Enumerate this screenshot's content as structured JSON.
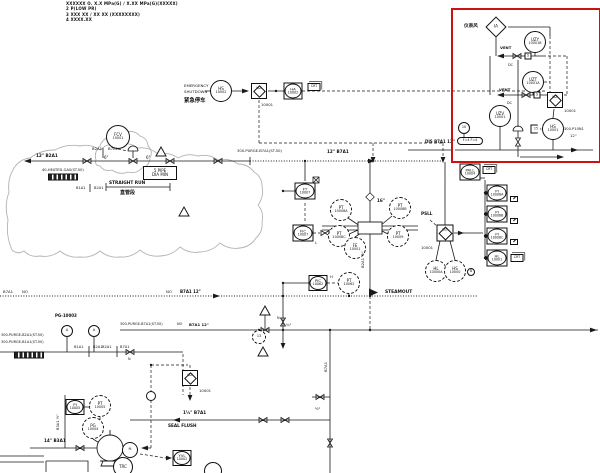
{
  "colors": {
    "highlight_box": "#cc1111",
    "diagram_line": "#1a1a1a",
    "cloud": "#b3b3b3"
  },
  "highlight_box": {
    "x": 451,
    "y": 8,
    "w": 146,
    "h": 151
  },
  "notes": [
    "XXXXXX O. X.X MPa(G) / X.XX MPa(G)(XXXXX)",
    "2    P(LOW PR)",
    "3    XXX XX / XX XX (XXXXXXXX)",
    "4    XXXX.XX"
  ],
  "instruments": [
    {
      "name": "instrument-air-diamond",
      "t": "diamond",
      "x": 496,
      "y": 27,
      "s": 15,
      "l1": "IA"
    },
    {
      "name": "uzy-10001b",
      "t": "circle",
      "x": 535,
      "y": 42,
      "r": 11,
      "l1": "UZY",
      "l2": "10001B"
    },
    {
      "name": "uzt-10001a",
      "t": "circle",
      "x": 533,
      "y": 82,
      "r": 11,
      "l1": "UZT",
      "l2": "10001A"
    },
    {
      "name": "uz-logic-redbox",
      "t": "logic",
      "x": 555,
      "y": 100,
      "s": 16,
      "l1": "UZ"
    },
    {
      "name": "uzv-10001",
      "t": "circle",
      "x": 500,
      "y": 116,
      "r": 11,
      "l1": "UZV",
      "l2": "10001"
    },
    {
      "name": "hs-10001",
      "t": "circle",
      "x": 553,
      "y": 129,
      "r": 11,
      "l1": "HS",
      "l2": "10001"
    },
    {
      "name": "flag-15",
      "t": "pent",
      "x": 536,
      "y": 129,
      "w": 11,
      "h": 9,
      "l1": "15"
    },
    {
      "name": "bubble-10",
      "t": "circle",
      "x": 464,
      "y": 128,
      "r": 6,
      "l1": "10"
    },
    {
      "name": "interlock-note",
      "t": "stadium",
      "x": 470,
      "y": 141,
      "w": 26,
      "h": 8,
      "l1": "F=4 F=4"
    },
    {
      "name": "solenoid-1",
      "t": "sbox",
      "x": 528,
      "y": 56,
      "w": 7,
      "h": 7,
      "l1": "S"
    },
    {
      "name": "solenoid-2",
      "t": "sbox",
      "x": 537,
      "y": 95,
      "w": 7,
      "h": 7,
      "l1": "S"
    },
    {
      "name": "hs-10002",
      "t": "circle",
      "x": 221,
      "y": 91,
      "r": 11,
      "l1": "HS",
      "l2": "10002"
    },
    {
      "name": "uz-logic-esd",
      "t": "logic",
      "x": 259,
      "y": 91,
      "s": 16,
      "l1": "UZ"
    },
    {
      "name": "ha-10002",
      "t": "sqcircle",
      "x": 293,
      "y": 91,
      "w": 19,
      "h": 17,
      "l1": "HA",
      "l2": "10002"
    },
    {
      "name": "crt-tag-esd",
      "t": "crt",
      "x": 314,
      "y": 87,
      "w": 13,
      "h": 8,
      "l1": "CRT"
    },
    {
      "name": "fcv-10001",
      "t": "circle",
      "x": 118,
      "y": 137,
      "r": 12,
      "l1": "FCV",
      "l2": "10001"
    },
    {
      "name": "ft-10007",
      "t": "sqcircle",
      "x": 305,
      "y": 191,
      "w": 21,
      "h": 17,
      "l1": "FT",
      "l2": "10007"
    },
    {
      "name": "fic-10007",
      "t": "sqcircle",
      "x": 303,
      "y": 233,
      "w": 21,
      "h": 17,
      "l1": "FIC",
      "l2": "10007"
    },
    {
      "name": "pt-10008a",
      "t": "circle",
      "x": 341,
      "y": 210,
      "r": 11,
      "dash": 1,
      "l1": "PT",
      "l2": "10008A"
    },
    {
      "name": "pt-10008b",
      "t": "circle",
      "x": 400,
      "y": 208,
      "r": 11,
      "dash": 1,
      "l1": "PT",
      "l2": "10008B"
    },
    {
      "name": "pt-10008c",
      "t": "circle",
      "x": 339,
      "y": 236,
      "r": 11,
      "dash": 1,
      "l1": "PT",
      "l2": "10008C"
    },
    {
      "name": "pt-10009",
      "t": "circle",
      "x": 398,
      "y": 236,
      "r": 11,
      "dash": 1,
      "l1": "PT",
      "l2": "10009"
    },
    {
      "name": "fe-10001",
      "t": "circle",
      "x": 355,
      "y": 248,
      "r": 11,
      "dash": 1,
      "l1": "FE",
      "l2": "10001"
    },
    {
      "name": "uz-logic-main",
      "t": "logic",
      "x": 445,
      "y": 233,
      "s": 17,
      "l1": "UZ"
    },
    {
      "name": "hl-10000a",
      "t": "circle",
      "x": 436,
      "y": 271,
      "r": 11,
      "dash": 1,
      "l1": "HL",
      "l2": "10000A"
    },
    {
      "name": "hs-10000",
      "t": "circle",
      "x": 455,
      "y": 271,
      "r": 11,
      "dash": 1,
      "l1": "HS",
      "l2": "10000"
    },
    {
      "name": "bubble-b",
      "t": "circle",
      "x": 471,
      "y": 272,
      "r": 4,
      "l1": "B"
    },
    {
      "name": "pall-10004",
      "t": "sqcircle",
      "x": 470,
      "y": 172,
      "w": 21,
      "h": 17,
      "l1": "PALL",
      "l2": "10004"
    },
    {
      "name": "crt-tag-pall",
      "t": "crt",
      "x": 489,
      "y": 170,
      "w": 13,
      "h": 8,
      "l1": "CRT"
    },
    {
      "name": "pi-10008a",
      "t": "sqcircle",
      "x": 497,
      "y": 193,
      "w": 21,
      "h": 17,
      "l1": "PI",
      "l2": "10008A"
    },
    {
      "name": "screen-tag-1",
      "t": "screen",
      "x": 514,
      "y": 199,
      "w": 8,
      "h": 6
    },
    {
      "name": "pi-10008b",
      "t": "sqcircle",
      "x": 497,
      "y": 214,
      "w": 21,
      "h": 17,
      "l1": "PI",
      "l2": "10008B"
    },
    {
      "name": "screen-tag-2",
      "t": "screen",
      "x": 514,
      "y": 221,
      "w": 8,
      "h": 6
    },
    {
      "name": "pi-10008c",
      "t": "sqcircle",
      "x": 497,
      "y": 236,
      "w": 21,
      "h": 17,
      "l1": "PI",
      "l2": "10008C"
    },
    {
      "name": "screen-tag-3",
      "t": "screen",
      "x": 514,
      "y": 242,
      "w": 8,
      "h": 6
    },
    {
      "name": "hl-10001-display",
      "t": "sqcircle",
      "x": 497,
      "y": 258,
      "w": 21,
      "h": 17,
      "l1": "HL",
      "l2": "10001"
    },
    {
      "name": "crt-tag-hl",
      "t": "crt",
      "x": 517,
      "y": 258,
      "w": 13,
      "h": 8,
      "l1": "CRT"
    },
    {
      "name": "pic-10062",
      "t": "sq circle sqcircle",
      "x": 318,
      "y": 283,
      "w": 19,
      "h": 16,
      "l1": "PIC",
      "l2": "10062"
    },
    {
      "name": "pt-10062",
      "t": "circle",
      "x": 349,
      "y": 283,
      "r": 11,
      "dash": 1,
      "l1": "PT",
      "l2": "10062"
    },
    {
      "name": "uz-logic-pump",
      "t": "logic",
      "x": 190,
      "y": 378,
      "s": 16,
      "l1": "UZ"
    },
    {
      "name": "junction-bubble",
      "t": "circle",
      "x": 151,
      "y": 396,
      "r": 5,
      "l1": ""
    },
    {
      "name": "pi-10005",
      "t": "sqcircle",
      "x": 75,
      "y": 407,
      "w": 19,
      "h": 16,
      "l1": "PI",
      "l2": "10005"
    },
    {
      "name": "pt-10005",
      "t": "circle",
      "x": 100,
      "y": 406,
      "r": 11,
      "dash": 1,
      "l1": "PT",
      "l2": "10005"
    },
    {
      "name": "pg-10004",
      "t": "circle",
      "x": 93,
      "y": 428,
      "r": 11,
      "dash": 1,
      "l1": "PG",
      "l2": "10004"
    },
    {
      "name": "motor-m",
      "t": "circle",
      "x": 130,
      "y": 450,
      "r": 8,
      "l1": "M"
    },
    {
      "name": "trc-bubble",
      "t": "circle",
      "x": 123,
      "y": 467,
      "r": 10,
      "l1": "TRC"
    },
    {
      "name": "yvl-10002",
      "t": "sqcircle",
      "x": 182,
      "y": 458,
      "w": 19,
      "h": 16,
      "l1": "YVL",
      "l2": "10002"
    },
    {
      "name": "gauge-a1",
      "t": "circle",
      "x": 67,
      "y": 331,
      "r": 6,
      "l1": "A"
    },
    {
      "name": "gauge-a2",
      "t": "circle",
      "x": 94,
      "y": 331,
      "r": 6,
      "l1": "A"
    },
    {
      "name": "orifice-13",
      "t": "circle",
      "x": 259,
      "y": 337,
      "r": 7,
      "dash": 1,
      "l1": "13"
    },
    {
      "name": "pipe-spec-box",
      "t": "box2",
      "x": 160,
      "y": 173,
      "w": 34,
      "h": 14,
      "l1": "5 PIPE",
      "l2": "DIA MIN"
    },
    {
      "name": "line-label-box-1",
      "t": "smear",
      "x": 63,
      "y": 177,
      "w": 30,
      "h": 7
    },
    {
      "name": "line-label-box-2",
      "t": "smear",
      "x": 29,
      "y": 355,
      "w": 30,
      "h": 7
    },
    {
      "name": "seal-pot-bubble",
      "t": "circle",
      "x": 213,
      "y": 471,
      "r": 9,
      "l1": ""
    }
  ],
  "labels": [
    {
      "x": 36,
      "y": 153,
      "t": "12\" B2A1",
      "s": 4.2,
      "b": 1
    },
    {
      "x": 92,
      "y": 146,
      "t": "B2A1",
      "s": 3.8
    },
    {
      "x": 108,
      "y": 146,
      "t": "B7A1",
      "s": 3.8
    },
    {
      "x": 104,
      "y": 155,
      "t": "6\"",
      "s": 4
    },
    {
      "x": 146,
      "y": 155,
      "t": "6\"",
      "s": 4
    },
    {
      "x": 42,
      "y": 168,
      "t": "40-HEATED-GAS(ST.50)",
      "s": 3.6
    },
    {
      "x": 108,
      "y": 181,
      "t": "STRAIGHT RUN",
      "s": 4.3,
      "b": 1,
      "bg": 1
    },
    {
      "x": 119,
      "y": 189,
      "t": "直管段",
      "s": 5,
      "b": 1,
      "bg": 1
    },
    {
      "x": 76,
      "y": 186,
      "t": "B1A1",
      "s": 3.6
    },
    {
      "x": 94,
      "y": 186,
      "t": "B2A1",
      "s": 3.6
    },
    {
      "x": 237,
      "y": 149,
      "t": "300-PURGE-B7A1(ST.50)",
      "s": 3.7
    },
    {
      "x": 327,
      "y": 149,
      "t": "12\" B7A1",
      "s": 4.2,
      "b": 1
    },
    {
      "x": 376,
      "y": 198,
      "t": "16\"",
      "s": 4.2,
      "b": 1,
      "bg": 1
    },
    {
      "x": 360,
      "y": 268,
      "t": "B2A1 ½\"",
      "s": 3.8,
      "r": -90
    },
    {
      "x": 425,
      "y": 139,
      "t": "DIS  B7A1 12\"",
      "s": 4,
      "b": 1
    },
    {
      "x": 564,
      "y": 127,
      "t": "300-P10N1",
      "s": 3.6
    },
    {
      "x": 570,
      "y": 133,
      "t": "12\"",
      "s": 3.8
    },
    {
      "x": 500,
      "y": 45,
      "t": "VENT",
      "s": 3.8,
      "b": 1
    },
    {
      "x": 499,
      "y": 87,
      "t": "VENT",
      "s": 3.8,
      "b": 1
    },
    {
      "x": 508,
      "y": 63,
      "t": "DC",
      "s": 3.4
    },
    {
      "x": 507,
      "y": 101,
      "t": "DC",
      "s": 3.4
    },
    {
      "x": 464,
      "y": 23,
      "t": "仪表风",
      "s": 4.6,
      "b": 1
    },
    {
      "x": 184,
      "y": 83,
      "t": "EMERGENCY",
      "s": 3.9
    },
    {
      "x": 184,
      "y": 89,
      "t": "SHUTDOWN",
      "s": 3.9
    },
    {
      "x": 184,
      "y": 96,
      "t": "紧急停车",
      "s": 5.4,
      "b": 1
    },
    {
      "x": 261,
      "y": 102,
      "t": "10001",
      "s": 3.8
    },
    {
      "x": 564,
      "y": 108,
      "t": "10001",
      "s": 3.8
    },
    {
      "x": 421,
      "y": 245,
      "t": "10001",
      "s": 3.8
    },
    {
      "x": 199,
      "y": 388,
      "t": "10001",
      "s": 3.8
    },
    {
      "x": 421,
      "y": 211,
      "t": "PSLL",
      "s": 4.2,
      "b": 1
    },
    {
      "x": 385,
      "y": 290,
      "t": "STEAMOUT",
      "s": 4.4,
      "b": 1
    },
    {
      "x": 3,
      "y": 289,
      "t": "B7A1",
      "s": 3.8
    },
    {
      "x": 22,
      "y": 289,
      "t": "NO",
      "s": 3.8
    },
    {
      "x": 166,
      "y": 289,
      "t": "NO",
      "s": 3.8
    },
    {
      "x": 180,
      "y": 289,
      "t": "B7A1 12\"",
      "s": 4,
      "b": 1
    },
    {
      "x": 55,
      "y": 313,
      "t": "PG-10003",
      "s": 4,
      "b": 1
    },
    {
      "x": 120,
      "y": 322,
      "t": "300-PURGE-B7A1(ST.50)",
      "s": 3.5
    },
    {
      "x": 177,
      "y": 322,
      "t": "NO",
      "s": 3.5
    },
    {
      "x": 189,
      "y": 322,
      "t": "B7A1 12\"",
      "s": 3.8,
      "b": 1
    },
    {
      "x": 1,
      "y": 333,
      "t": "300-PURGE-B2A1(ST.50)",
      "s": 3.5
    },
    {
      "x": 1,
      "y": 340,
      "t": "300-PURGE-B1A1(ST.50)",
      "s": 3.5
    },
    {
      "x": 74,
      "y": 345,
      "t": "B1A1",
      "s": 3.6
    },
    {
      "x": 93,
      "y": 345,
      "t": "B2A1",
      "s": 3.6
    },
    {
      "x": 102,
      "y": 345,
      "t": "B2A1",
      "s": 3.6
    },
    {
      "x": 120,
      "y": 345,
      "t": "B7A1",
      "s": 3.6
    },
    {
      "x": 44,
      "y": 438,
      "t": "14\"  B3A1",
      "s": 4.2,
      "b": 1
    },
    {
      "x": 56,
      "y": 430,
      "t": "B3A1 ½\"",
      "s": 3.6,
      "r": -90
    },
    {
      "x": 183,
      "y": 410,
      "t": "1½\" B7A1",
      "s": 4.2,
      "b": 1
    },
    {
      "x": 168,
      "y": 423,
      "t": "SEAL FLUSH",
      "s": 4.2,
      "b": 1
    },
    {
      "x": 286,
      "y": 322,
      "t": "¾\"",
      "s": 3.8
    },
    {
      "x": 277,
      "y": 316,
      "t": "N",
      "s": 3.4
    },
    {
      "x": 315,
      "y": 406,
      "t": "½\"",
      "s": 3.8
    },
    {
      "x": 323,
      "y": 372,
      "t": "B7A1",
      "s": 3.8,
      "r": -90
    },
    {
      "x": 330,
      "y": 274,
      "t": "H",
      "s": 3.8
    },
    {
      "x": 315,
      "y": 240,
      "t": "L",
      "s": 3.8
    },
    {
      "x": 128,
      "y": 357,
      "t": "N",
      "s": 3.4
    }
  ],
  "clouds": {
    "big": [
      [
        12,
        250
      ],
      [
        8,
        220
      ],
      [
        9,
        192
      ],
      [
        14,
        168
      ],
      [
        30,
        158
      ],
      [
        55,
        150
      ],
      [
        80,
        146
      ],
      [
        100,
        150
      ],
      [
        118,
        144
      ],
      [
        138,
        148
      ],
      [
        158,
        154
      ],
      [
        178,
        158
      ],
      [
        198,
        156
      ],
      [
        218,
        160
      ],
      [
        238,
        164
      ],
      [
        254,
        172
      ],
      [
        262,
        186
      ],
      [
        258,
        205
      ],
      [
        262,
        222
      ],
      [
        256,
        238
      ],
      [
        240,
        248
      ],
      [
        220,
        243
      ],
      [
        200,
        252
      ],
      [
        180,
        247
      ],
      [
        160,
        256
      ],
      [
        140,
        250
      ],
      [
        120,
        257
      ],
      [
        100,
        251
      ],
      [
        80,
        257
      ],
      [
        60,
        251
      ],
      [
        40,
        256
      ],
      [
        24,
        251
      ],
      [
        12,
        250
      ]
    ],
    "small": [
      [
        96,
        160
      ],
      [
        100,
        146
      ],
      [
        112,
        136
      ],
      [
        126,
        132
      ],
      [
        140,
        136
      ],
      [
        148,
        146
      ],
      [
        150,
        158
      ],
      [
        142,
        168
      ],
      [
        128,
        172
      ],
      [
        112,
        170
      ],
      [
        100,
        166
      ],
      [
        96,
        160
      ]
    ]
  }
}
